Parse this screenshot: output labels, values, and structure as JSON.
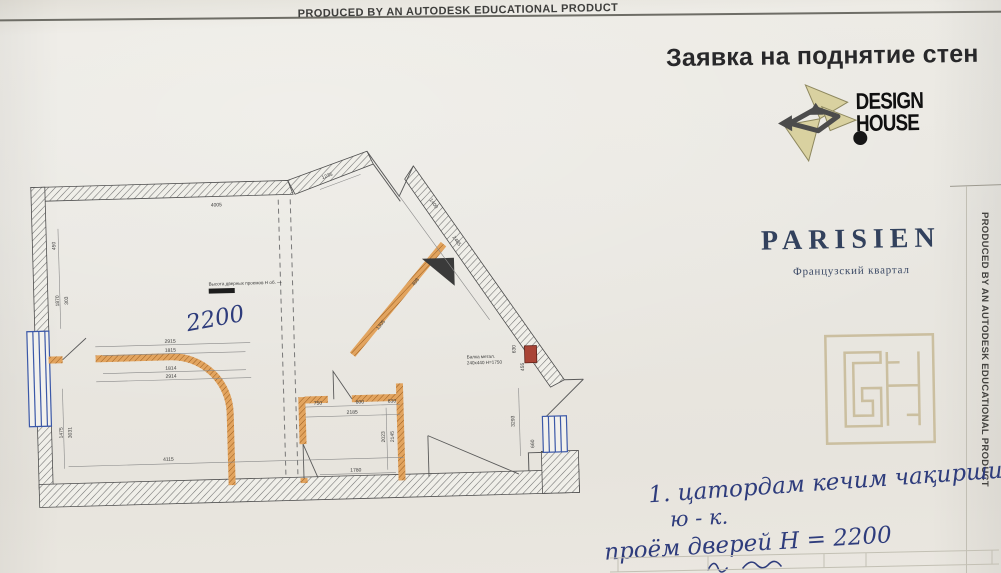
{
  "banner": {
    "top_text": "PRODUCED BY AN AUTODESK EDUCATIONAL PRODUCT",
    "side_text": "PRODUCED BY AN AUTODESK EDUCATIONAL PRODUCT"
  },
  "header": {
    "title": "Заявка на поднятие стен"
  },
  "logos": {
    "design_house": {
      "line1": "DESIGN",
      "line2": "HOUSE"
    },
    "parisien": {
      "name": "PARISIEN",
      "subtitle": "Французский квартал"
    }
  },
  "notes": {
    "line1": "1. цатордам кечим чақирши",
    "line2": "ю - к.",
    "line3": "проём дверей Н = 2200"
  },
  "plan": {
    "printed_note": "Высота дверных проемов Н об. —",
    "handwritten_height": "2200",
    "beam_label_line1": "Балка метал.",
    "beam_label_line2": "240х440 Н=1750",
    "dimensions": [
      {
        "t": "4005",
        "x": 200,
        "y": 62,
        "r": 0
      },
      {
        "t": "450",
        "x": 38,
        "y": 97,
        "r": -90
      },
      {
        "t": "1870",
        "x": 40,
        "y": 152,
        "r": -90
      },
      {
        "t": "303",
        "x": 49,
        "y": 152,
        "r": -90
      },
      {
        "t": "1475",
        "x": 40,
        "y": 284,
        "r": -90
      },
      {
        "t": "3031",
        "x": 49,
        "y": 284,
        "r": -90
      },
      {
        "t": "2915",
        "x": 150,
        "y": 197,
        "r": 0
      },
      {
        "t": "1815",
        "x": 150,
        "y": 206,
        "r": 0
      },
      {
        "t": "1814",
        "x": 150,
        "y": 224,
        "r": 0
      },
      {
        "t": "2914",
        "x": 150,
        "y": 232,
        "r": 0
      },
      {
        "t": "4115",
        "x": 145,
        "y": 315,
        "r": 0
      },
      {
        "t": "750",
        "x": 296,
        "y": 263,
        "r": 0
      },
      {
        "t": "800",
        "x": 338,
        "y": 263,
        "r": 0
      },
      {
        "t": "630",
        "x": 370,
        "y": 263,
        "r": 0
      },
      {
        "t": "2185",
        "x": 330,
        "y": 273,
        "r": 0
      },
      {
        "t": "1780",
        "x": 332,
        "y": 331,
        "r": 0
      },
      {
        "t": "2023",
        "x": 362,
        "y": 297,
        "r": -90
      },
      {
        "t": "2145",
        "x": 371,
        "y": 297,
        "r": -90
      },
      {
        "t": "1235",
        "x": 312,
        "y": 36,
        "r": -19
      },
      {
        "t": "1400",
        "x": 416,
        "y": 66,
        "r": 56
      },
      {
        "t": "2485",
        "x": 438,
        "y": 104,
        "r": 56
      },
      {
        "t": "1305",
        "x": 362,
        "y": 186,
        "r": -49
      },
      {
        "t": "498",
        "x": 398,
        "y": 144,
        "r": -49
      },
      {
        "t": "630",
        "x": 495,
        "y": 213,
        "r": -90
      },
      {
        "t": "455",
        "x": 503,
        "y": 231,
        "r": -90
      },
      {
        "t": "3293",
        "x": 492,
        "y": 285,
        "r": -90
      },
      {
        "t": "660",
        "x": 511,
        "y": 308,
        "r": -90
      }
    ],
    "colors": {
      "existing_wall_hatch": "#6f6f6f",
      "new_wall": "#e2a45f",
      "window": "#3b58a8",
      "ink": "#2e3c7c",
      "column_red": "#a94436",
      "monogram": "#cbbfa0",
      "parisien_navy": "#32415d",
      "logo_khaki": "#d9d1a0"
    }
  }
}
